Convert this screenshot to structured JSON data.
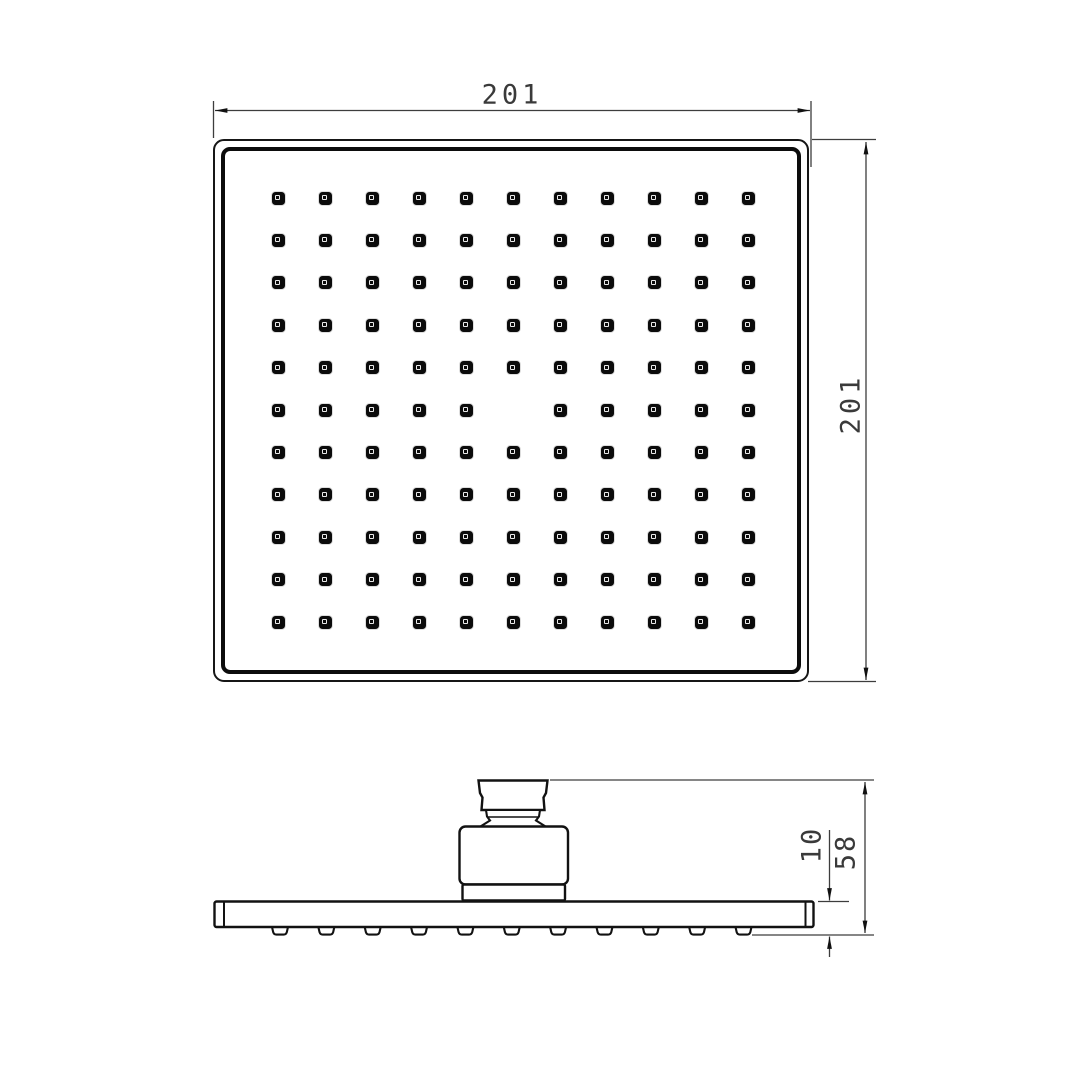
{
  "background_color": "#ffffff",
  "line_color": "#161616",
  "dim_line_color": "#3d3d3d",
  "top_view": {
    "width_label": "201",
    "height_label": "201",
    "nozzle_grid": {
      "columns": 11,
      "rows": 11,
      "missing_cells": [
        {
          "row": 6,
          "column": 6
        }
      ]
    }
  },
  "side_view": {
    "overall_height_label": "58",
    "plate_thickness_label": "10",
    "bump_count": 11
  }
}
